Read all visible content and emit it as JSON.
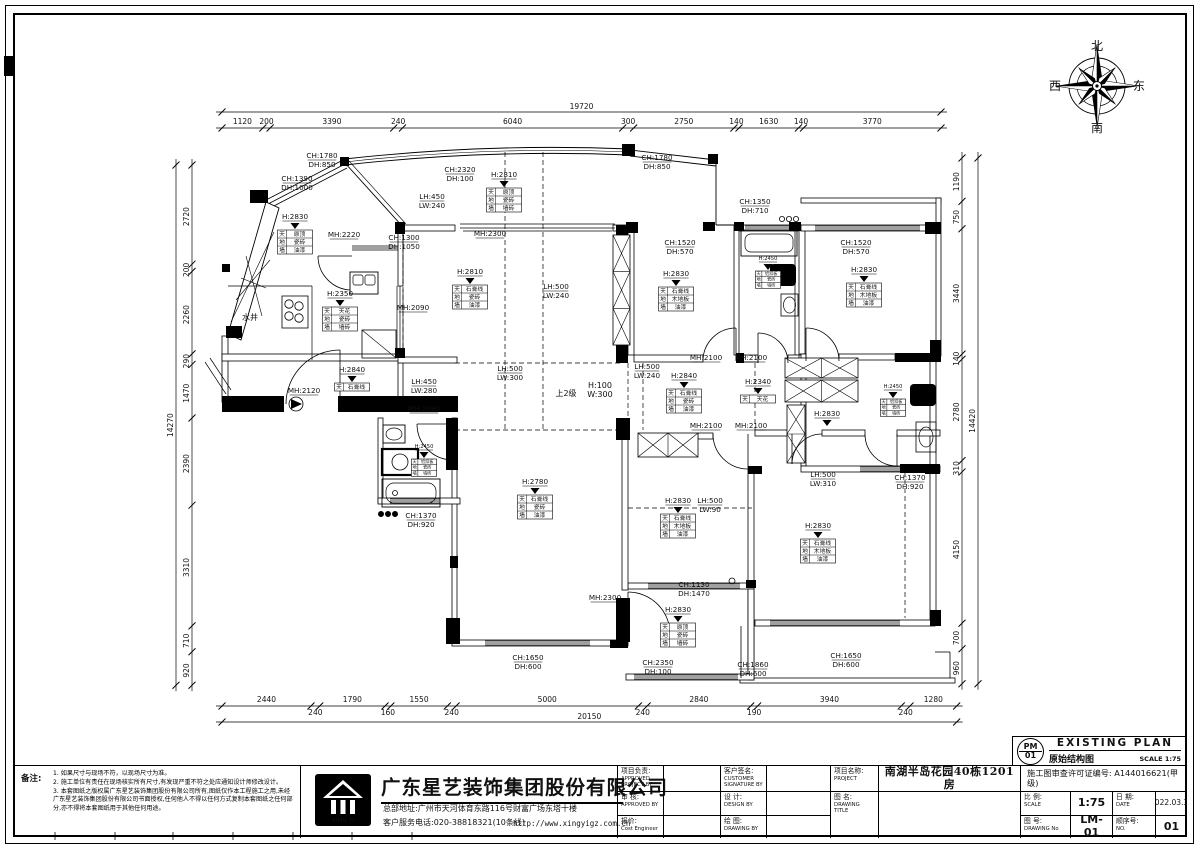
{
  "plan_header": {
    "code_top": "PM",
    "code_bottom": "01",
    "title_en": "EXISTING PLAN",
    "title_cn": "原始结构图",
    "scale": "SCALE 1:75"
  },
  "compass": {
    "n": "北",
    "s": "南",
    "w": "西",
    "e": "东"
  },
  "notes": {
    "title": "备注:",
    "items": [
      "1. 如果尺寸与现场不符，以现场尺寸为准。",
      "2. 施工单位有责任在现场核实所有尺寸,有发现严重不符之处应通知设计师修改设计。",
      "3. 本套图纸之版权属广东星艺装饰集团股份有限公司所有,图纸仅作本工程施工之用,未经广东星艺装饰集团股份有限公司书面授权,任何他人不得以任何方式复制本套图纸之任何部分,亦不得将本套图纸用于其他任何用途。"
    ]
  },
  "company": {
    "name": "广东星艺装饰集团股份有限公司",
    "address": "总部地址:广州市天河体育东路116号财富广场东塔十楼",
    "phone": "客户服务电话:020-38818321(10条线)",
    "website": "http://www.xingyigz.com.cn",
    "logo_caption": "XING YI"
  },
  "titleblock": {
    "project_lead": {
      "label": "项目负责:",
      "en1": "APPROVED",
      "en2": "PROJECT BY"
    },
    "customer": {
      "label": "客户签名:",
      "en1": "CUSTOMER",
      "en2": "SIGNATURE BY"
    },
    "check": {
      "label": "审 核:",
      "en1": "APPROVED BY",
      "en2": ""
    },
    "design": {
      "label": "设 计:",
      "en1": "DESIGN BY",
      "en2": ""
    },
    "cost": {
      "label": "报价:",
      "en1": "Cost Engineer",
      "en2": ""
    },
    "draw": {
      "label": "绘 图:",
      "en1": "DRAWING BY",
      "en2": ""
    },
    "project": {
      "label": "项目名称:",
      "en": "PROJECT",
      "value": "南湖半岛花园40栋1201房"
    },
    "drawing_title": {
      "label": "图 名:",
      "en": "DRAWING TITLE",
      "value": ""
    },
    "license": "施工图审查许可证编号: A144016621(甲级)",
    "scale": {
      "label": "比 例:",
      "en": "SCALE",
      "value": "1:75"
    },
    "date": {
      "label": "日 期:",
      "en": "DATE",
      "value": "2022.03.31"
    },
    "drawing_no": {
      "label": "图 号:",
      "en": "DRAWING No",
      "value": "LM-01"
    },
    "seq": {
      "label": "顺序号:",
      "en": "NO.",
      "value": "01"
    }
  },
  "dimensions": {
    "top": {
      "total": "19720",
      "values": [
        1120,
        200,
        3390,
        240,
        6040,
        300,
        2750,
        140,
        1630,
        140,
        3770
      ]
    },
    "bottom": {
      "total": "20150",
      "values": [
        2440,
        240,
        1790,
        160,
        1550,
        240,
        5000,
        240,
        2840,
        190,
        3940,
        240,
        1280
      ]
    },
    "left": {
      "total": "14270",
      "values": [
        2720,
        200,
        2260,
        290,
        1470,
        2390,
        3310,
        710,
        920
      ]
    },
    "right": {
      "total": "14420",
      "values": [
        1190,
        750,
        3440,
        140,
        2780,
        310,
        4150,
        700,
        960
      ]
    }
  },
  "labels": [
    {
      "x": 322,
      "y": 158,
      "t": "CH:1780\nDH:850"
    },
    {
      "x": 657,
      "y": 160,
      "t": "CH:1780\nDH:850"
    },
    {
      "x": 297,
      "y": 181,
      "t": "CH:1390\nDH:1000"
    },
    {
      "x": 460,
      "y": 172,
      "t": "CH:2320\nDH:100"
    },
    {
      "x": 755,
      "y": 204,
      "t": "CH:1350\nDH:710"
    },
    {
      "x": 680,
      "y": 245,
      "t": "CH:1520\nDH:570"
    },
    {
      "x": 856,
      "y": 245,
      "t": "CH:1520\nDH:570"
    },
    {
      "x": 404,
      "y": 240,
      "t": "CH:1300\nDH:1050"
    },
    {
      "x": 344,
      "y": 237,
      "t": "MH:2220"
    },
    {
      "x": 432,
      "y": 199,
      "t": "LH:450\nLW:240"
    },
    {
      "x": 490,
      "y": 236,
      "t": "MH:2300"
    },
    {
      "x": 413,
      "y": 310,
      "t": "MH:2090"
    },
    {
      "x": 556,
      "y": 289,
      "t": "LH:500\nLW:240"
    },
    {
      "x": 250,
      "y": 320,
      "t": "水井",
      "plain": true
    },
    {
      "x": 304,
      "y": 393,
      "t": "MH:2120"
    },
    {
      "x": 424,
      "y": 384,
      "t": "LH:450\nLW:280"
    },
    {
      "x": 424,
      "y": 411,
      "t": "MH:2090"
    },
    {
      "x": 510,
      "y": 371,
      "t": "LH:500\nLW:300"
    },
    {
      "x": 566,
      "y": 396,
      "t": "上2级",
      "plain": true
    },
    {
      "x": 600,
      "y": 388,
      "t": "H:100\nW:300",
      "plain": true
    },
    {
      "x": 647,
      "y": 369,
      "t": "LH:500\nLW:240"
    },
    {
      "x": 706,
      "y": 360,
      "t": "MH:2100"
    },
    {
      "x": 751,
      "y": 360,
      "t": "MH:2100"
    },
    {
      "x": 706,
      "y": 428,
      "t": "MH:2100"
    },
    {
      "x": 751,
      "y": 428,
      "t": "MH:2100"
    },
    {
      "x": 823,
      "y": 477,
      "t": "LH:500\nLW:310"
    },
    {
      "x": 910,
      "y": 480,
      "t": "CH:1370\nDH:920"
    },
    {
      "x": 421,
      "y": 518,
      "t": "CH:1370\nDH:920"
    },
    {
      "x": 605,
      "y": 600,
      "t": "MH:2300"
    },
    {
      "x": 694,
      "y": 587,
      "t": "CH:1130\nDH:1470"
    },
    {
      "x": 710,
      "y": 503,
      "t": "LH:500\nLW:90"
    },
    {
      "x": 528,
      "y": 660,
      "t": "CH:1650\nDH:600"
    },
    {
      "x": 658,
      "y": 665,
      "t": "CH:2350\nDH:100"
    },
    {
      "x": 753,
      "y": 667,
      "t": "CH:1860\nDH:600"
    },
    {
      "x": 846,
      "y": 658,
      "t": "CH:1650\nDH:600"
    }
  ],
  "finish_flags": [
    {
      "x": 295,
      "y": 219,
      "h": "H:2830",
      "rows": [
        [
          "天",
          "原顶"
        ],
        [
          "地",
          "瓷砖"
        ],
        [
          "墙",
          "油漆"
        ]
      ]
    },
    {
      "x": 340,
      "y": 296,
      "h": "H:2350",
      "rows": [
        [
          "天",
          "天花"
        ],
        [
          "地",
          "瓷砖"
        ],
        [
          "墙",
          "墙砖"
        ]
      ]
    },
    {
      "x": 504,
      "y": 177,
      "h": "H:2810",
      "rows": [
        [
          "天",
          "原顶"
        ],
        [
          "地",
          "瓷砖"
        ],
        [
          "墙",
          "墙砖"
        ]
      ]
    },
    {
      "x": 470,
      "y": 274,
      "h": "H:2810",
      "rows": [
        [
          "天",
          "石膏线"
        ],
        [
          "地",
          "瓷砖"
        ],
        [
          "墙",
          "油漆"
        ]
      ]
    },
    {
      "x": 676,
      "y": 276,
      "h": "H:2830",
      "rows": [
        [
          "天",
          "石膏线"
        ],
        [
          "地",
          "木地板"
        ],
        [
          "墙",
          "油漆"
        ]
      ]
    },
    {
      "x": 768,
      "y": 260,
      "h": "H:2450",
      "small": true,
      "rows": [
        [
          "天",
          "铝扣板"
        ],
        [
          "地",
          "瓷砖"
        ],
        [
          "墙",
          "墙砖"
        ]
      ]
    },
    {
      "x": 864,
      "y": 272,
      "h": "H:2830",
      "rows": [
        [
          "天",
          "石膏线"
        ],
        [
          "地",
          "木地板"
        ],
        [
          "墙",
          "油漆"
        ]
      ]
    },
    {
      "x": 352,
      "y": 372,
      "h": "H:2840",
      "rows": [
        [
          "天",
          "石膏线"
        ]
      ]
    },
    {
      "x": 684,
      "y": 378,
      "h": "H:2840",
      "rows": [
        [
          "天",
          "石膏线"
        ],
        [
          "地",
          "瓷砖"
        ],
        [
          "墙",
          "油漆"
        ]
      ]
    },
    {
      "x": 758,
      "y": 384,
      "h": "H:2340",
      "rows": [
        [
          "天",
          "天花"
        ]
      ]
    },
    {
      "x": 827,
      "y": 416,
      "h": "H:2830",
      "rows": []
    },
    {
      "x": 893,
      "y": 388,
      "h": "H:2450",
      "small": true,
      "rows": [
        [
          "天",
          "铝扣板"
        ],
        [
          "地",
          "瓷砖"
        ],
        [
          "墙",
          "墙砖"
        ]
      ]
    },
    {
      "x": 535,
      "y": 484,
      "h": "H:2780",
      "rows": [
        [
          "天",
          "石膏线"
        ],
        [
          "地",
          "瓷砖"
        ],
        [
          "墙",
          "油漆"
        ]
      ]
    },
    {
      "x": 678,
      "y": 503,
      "h": "H:2830",
      "rows": [
        [
          "天",
          "石膏线"
        ],
        [
          "地",
          "木地板"
        ],
        [
          "墙",
          "油漆"
        ]
      ]
    },
    {
      "x": 678,
      "y": 612,
      "h": "H:2830",
      "rows": [
        [
          "天",
          "原顶"
        ],
        [
          "地",
          "瓷砖"
        ],
        [
          "墙",
          "墙砖"
        ]
      ]
    },
    {
      "x": 818,
      "y": 528,
      "h": "H:2830",
      "rows": [
        [
          "天",
          "石膏线"
        ],
        [
          "地",
          "木地板"
        ],
        [
          "墙",
          "油漆"
        ]
      ]
    },
    {
      "x": 424,
      "y": 448,
      "h": "H:2450",
      "small": true,
      "rows": [
        [
          "天",
          "铝扣板"
        ],
        [
          "地",
          "瓷砖"
        ],
        [
          "墙",
          "墙砖"
        ]
      ]
    }
  ]
}
